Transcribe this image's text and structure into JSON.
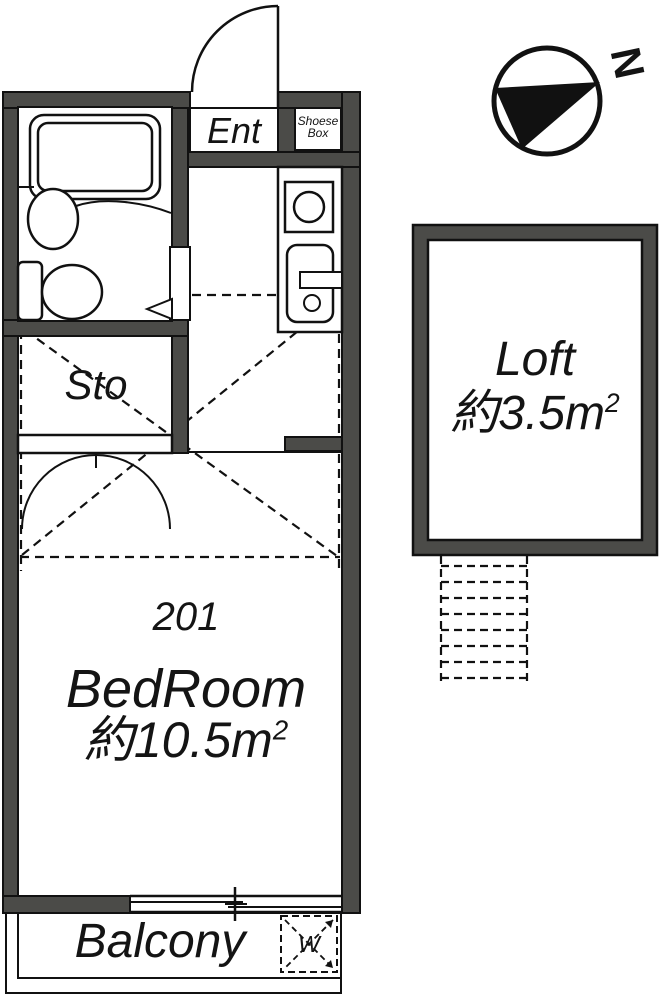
{
  "plan": {
    "unit_number": "201",
    "entrance": {
      "label": "Ent"
    },
    "shoes_box": {
      "line1": "Shoese",
      "line2": "Box"
    },
    "storage": {
      "label": "Sto"
    },
    "bedroom": {
      "number": "201",
      "label": "BedRoom",
      "area": "約10.5m",
      "area_sup": "2"
    },
    "loft": {
      "label": "Loft",
      "area": "約3.5m",
      "area_sup": "2"
    },
    "balcony": {
      "label": "Balcony",
      "washer_label": "W"
    },
    "compass": {
      "label": "N"
    },
    "colors": {
      "wall": "#4b4b48",
      "line": "#111111",
      "background": "#ffffff"
    }
  }
}
